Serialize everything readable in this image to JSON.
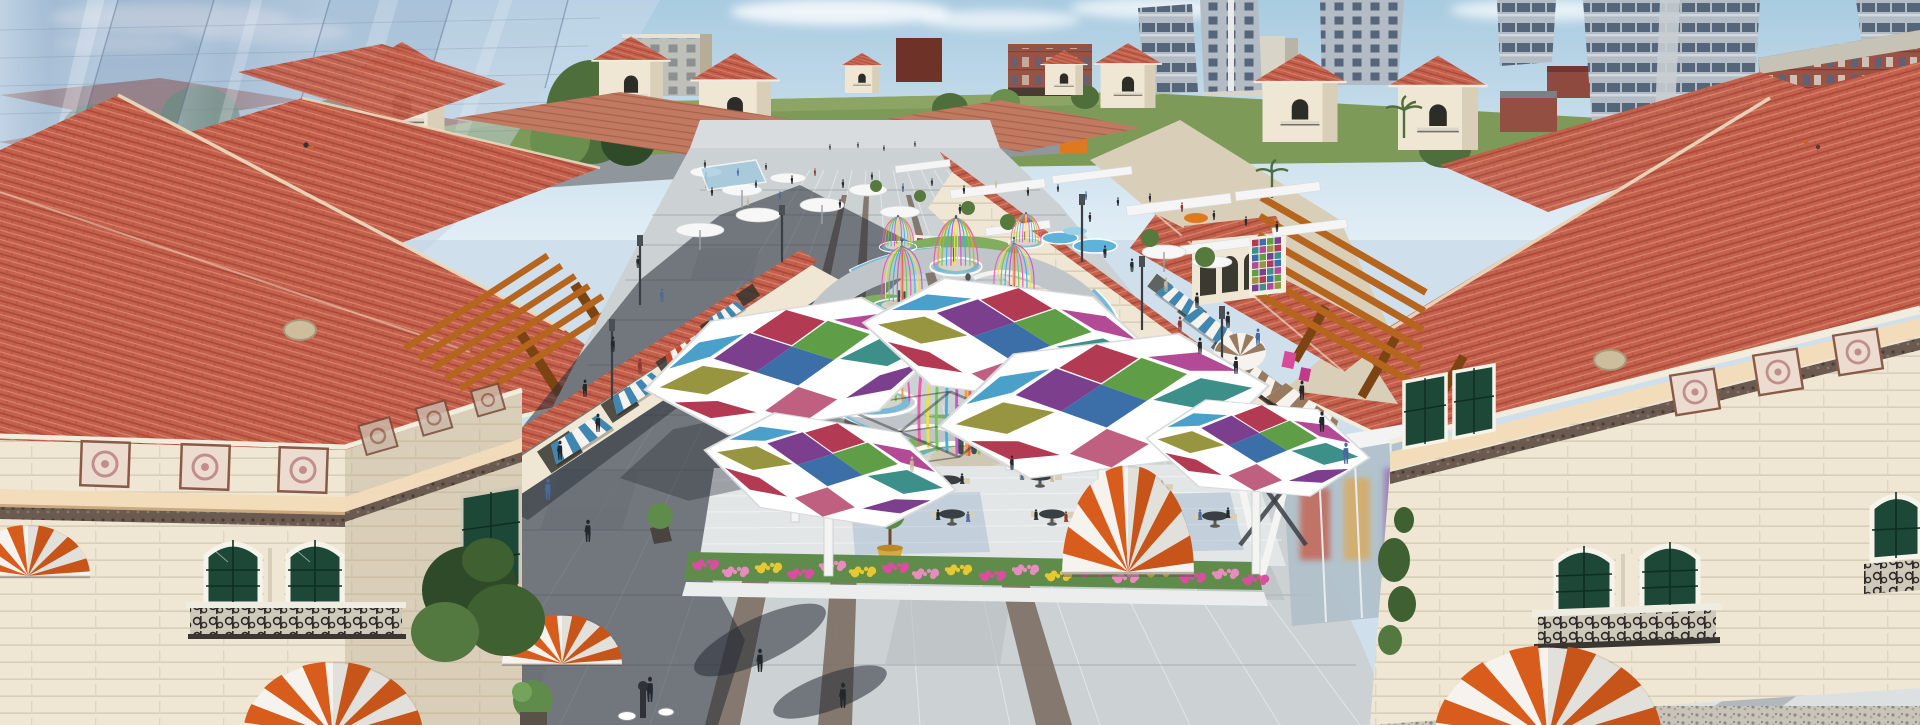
{
  "scene": {
    "type": "3d-architectural-rendering",
    "view": "aerial-perspective",
    "subject": "Aerial rendering of a Mediterranean-style outdoor shopping plaza with red tile roofs, colorful stained-glass hex canopies, ribbon dome pavilions, cafe terrace and striped awnings",
    "landmarks": [
      "red-tile-roof retail buildings",
      "corner towers with pyramid roofs",
      "translucent glass high-rises (left skyline)",
      "residential towers and brick mid-rises (right skyline)",
      "green horizon fields and distant street with crosswalk",
      "central pedestrian promenade with stone paving and brown accent strips",
      "ribbon birdcage pavilions on circular water ring",
      "stained-glass hexagonal canopies",
      "outdoor cafe terrace with round tables and topiary pots",
      "flower beds",
      "orange-and-white striped dome awnings",
      "blue and brown striped storefront awnings",
      "orange wood pergolas on roof terraces",
      "white pergola frames in far plaza",
      "crowds of shoppers",
      "street lamps",
      "tile mosaic murals",
      "green arched windows with iron balconies"
    ],
    "counts": {
      "hex_canopies": 5,
      "ribbon_pavilions": 8,
      "striped_dome_awnings": 5,
      "storefront_awnings": 9,
      "cafe_tables": 7,
      "corner_towers": 8
    }
  },
  "palette": {
    "sky_top": "#a9cbe0",
    "sky_low": "#e2eef6",
    "cloud": "#ffffff",
    "field": "#7d9a59",
    "field_light": "#93a86a",
    "road": "#8f979c",
    "tree": "#4e6e3c",
    "tree_light": "#6b8f4e",
    "tree_dark": "#2f4a28",
    "glass": "#9fb2cc",
    "glass_light": "#cfdcea",
    "glass_edge": "#5f7292",
    "tower_gray": "#b3bcc4",
    "tower_win": "#55657a",
    "tower_slab": "#d2d7db",
    "brick": "#9a5244",
    "brick_dark": "#6e3228",
    "concrete": "#c6c2b6",
    "beige_bldg": "#cfc4ae",
    "white_bldg": "#d8d4c8",
    "red_bldg": "#96523f",
    "roof": "#c4604c",
    "roof_dark": "#a84a3a",
    "roof_light": "#dc8d74",
    "ridge": "#ead9bd",
    "eave": "#f2ecdc",
    "wall": "#efe7d3",
    "wall_shade": "#d9cfb8",
    "wall_dark": "#cbbfa4",
    "trim_peach": "#f3dcba",
    "frieze": "#6b5a50",
    "panel_bg": "#ecdcd0",
    "panel_fg": "#c08e8e",
    "win_green": "#1d4736",
    "win_frame": "#f6f3ea",
    "iron": "#2e2a28",
    "pergola": "#b5651d",
    "pergola_dark": "#7c4412",
    "pave": "#ccd1d3",
    "pave_light": "#dde0e1",
    "pave_dark": "#b7bdc0",
    "strip_brown": "#7d6e63",
    "shadow": "rgba(40,46,54,0.55)",
    "shadow_deep": "rgba(40,46,54,0.5)",
    "grass": "#7fae5e",
    "water": "#5fb3d8",
    "water_light": "#9ad2e8",
    "cp_red": "#b23a52",
    "cp_purple": "#7b3f8e",
    "cp_green": "#5f9e46",
    "cp_blue": "#3c6fa8",
    "cp_teal": "#3d8f8a",
    "cp_olive": "#97953f",
    "cp_magenta": "#b24a96",
    "cp_sky": "#4aa0c8",
    "cp_rose": "#c06080",
    "rb_pink": "#e85fb0",
    "rb_orange": "#f0a030",
    "rb_green": "#78c84e",
    "rb_blue": "#46b0e0",
    "rb_purple": "#c85ad0",
    "rb_yellow": "#f0e048",
    "rb_red": "#e8604e",
    "awn_blue": "#3f87b0",
    "awn_brown": "#9a7a5e",
    "awn_red": "#c84a2a",
    "awn_white": "#f6f3ee",
    "umb_orange": "#d85c1c",
    "table": "#3a3f43",
    "chair": "#d9cfb5",
    "pot_yellow": "#d8a93e",
    "flower_pink": "#e88cc0",
    "flower_magenta": "#d94fa0",
    "flower_yellow": "#e8c832",
    "person": "#23282d",
    "person_blue": "#4a6a9a",
    "person_red": "#8a3a30",
    "person_tan": "#c8b89a"
  },
  "mosaic": {
    "colors": [
      "cp_red",
      "cp_blue",
      "cp_green",
      "cp_purple",
      "cp_teal",
      "cp_magenta",
      "cp_olive"
    ]
  },
  "people": {
    "far": [
      [
        705,
        168,
        8,
        "person"
      ],
      [
        738,
        176,
        8,
        "person_blue"
      ],
      [
        766,
        170,
        7,
        "person"
      ],
      [
        792,
        184,
        9,
        "person"
      ],
      [
        815,
        176,
        8,
        "person_red"
      ],
      [
        843,
        188,
        9,
        "person"
      ],
      [
        872,
        180,
        8,
        "person"
      ],
      [
        903,
        192,
        9,
        "person_blue"
      ],
      [
        932,
        186,
        8,
        "person"
      ],
      [
        964,
        194,
        9,
        "person"
      ],
      [
        996,
        188,
        8,
        "person_tan"
      ],
      [
        1028,
        196,
        9,
        "person"
      ],
      [
        1058,
        192,
        8,
        "person"
      ],
      [
        1086,
        200,
        9,
        "person_blue"
      ],
      [
        1118,
        206,
        9,
        "person"
      ],
      [
        1150,
        202,
        9,
        "person"
      ],
      [
        1182,
        212,
        10,
        "person_red"
      ],
      [
        1214,
        220,
        10,
        "person"
      ],
      [
        1246,
        226,
        10,
        "person"
      ],
      [
        1277,
        232,
        11,
        "person"
      ],
      [
        712,
        196,
        9,
        "person"
      ],
      [
        748,
        206,
        9,
        "person_tan"
      ],
      [
        840,
        208,
        9,
        "person"
      ],
      [
        960,
        214,
        10,
        "person"
      ],
      [
        1090,
        222,
        10,
        "person"
      ],
      [
        830,
        150,
        6,
        "person"
      ],
      [
        858,
        148,
        6,
        "person"
      ],
      [
        884,
        151,
        6,
        "person"
      ],
      [
        915,
        147,
        6,
        "person"
      ],
      [
        756,
        188,
        8,
        "person"
      ],
      [
        780,
        200,
        9,
        "person_blue"
      ]
    ],
    "near": [
      [
        638,
        268,
        13,
        "person"
      ],
      [
        662,
        302,
        14,
        "person_blue"
      ],
      [
        613,
        352,
        16,
        "person"
      ],
      [
        585,
        397,
        18,
        "person"
      ],
      [
        640,
        374,
        16,
        "person_red"
      ],
      [
        598,
        432,
        19,
        "person"
      ],
      [
        560,
        460,
        20,
        "person"
      ],
      [
        548,
        500,
        22,
        "person_blue"
      ],
      [
        588,
        542,
        23,
        "person"
      ],
      [
        1105,
        258,
        13,
        "person"
      ],
      [
        1132,
        272,
        14,
        "person"
      ],
      [
        1166,
        292,
        15,
        "person_tan"
      ],
      [
        1197,
        308,
        16,
        "person"
      ],
      [
        1228,
        328,
        17,
        "person"
      ],
      [
        1258,
        346,
        18,
        "person_blue"
      ],
      [
        1200,
        354,
        17,
        "person"
      ],
      [
        1236,
        374,
        18,
        "person"
      ],
      [
        1180,
        332,
        16,
        "person_red"
      ],
      [
        1302,
        400,
        20,
        "person"
      ],
      [
        1322,
        432,
        21,
        "person"
      ],
      [
        1346,
        464,
        22,
        "person_blue"
      ],
      [
        650,
        702,
        26,
        "person"
      ],
      [
        843,
        708,
        26,
        "person"
      ],
      [
        760,
        672,
        24,
        "person"
      ],
      [
        912,
        472,
        16,
        "person_tan"
      ],
      [
        1012,
        470,
        15,
        "person"
      ]
    ],
    "seated": [
      [
        930,
        486,
        13,
        "person_red"
      ],
      [
        962,
        484,
        13,
        "person"
      ],
      [
        1022,
        480,
        12,
        "person_blue"
      ],
      [
        1052,
        482,
        12,
        "person_tan"
      ],
      [
        938,
        520,
        13,
        "person"
      ],
      [
        968,
        522,
        13,
        "person_blue"
      ],
      [
        1036,
        520,
        13,
        "person"
      ],
      [
        1066,
        522,
        13,
        "person_red"
      ],
      [
        1140,
        486,
        12,
        "person"
      ],
      [
        1162,
        490,
        12,
        "person_tan"
      ],
      [
        1200,
        520,
        13,
        "person_blue"
      ],
      [
        1228,
        518,
        13,
        "person"
      ],
      [
        1096,
        550,
        13,
        "person"
      ],
      [
        1122,
        552,
        13,
        "person_tan"
      ]
    ]
  },
  "flowers": {
    "clusters": [
      [
        705,
        565,
        "flower_magenta"
      ],
      [
        735,
        572,
        "flower_pink"
      ],
      [
        768,
        568,
        "flower_yellow"
      ],
      [
        800,
        574,
        "flower_magenta"
      ],
      [
        832,
        566,
        "flower_pink"
      ],
      [
        862,
        572,
        "flower_yellow"
      ],
      [
        895,
        568,
        "flower_magenta"
      ],
      [
        925,
        574,
        "flower_pink"
      ],
      [
        958,
        570,
        "flower_yellow"
      ],
      [
        992,
        576,
        "flower_magenta"
      ],
      [
        1025,
        570,
        "flower_pink"
      ],
      [
        1058,
        576,
        "flower_yellow"
      ],
      [
        1092,
        572,
        "flower_magenta"
      ],
      [
        1125,
        578,
        "flower_pink"
      ],
      [
        1158,
        572,
        "flower_yellow"
      ],
      [
        1192,
        578,
        "flower_magenta"
      ],
      [
        1225,
        574,
        "flower_pink"
      ],
      [
        1255,
        580,
        "flower_magenta"
      ]
    ]
  }
}
